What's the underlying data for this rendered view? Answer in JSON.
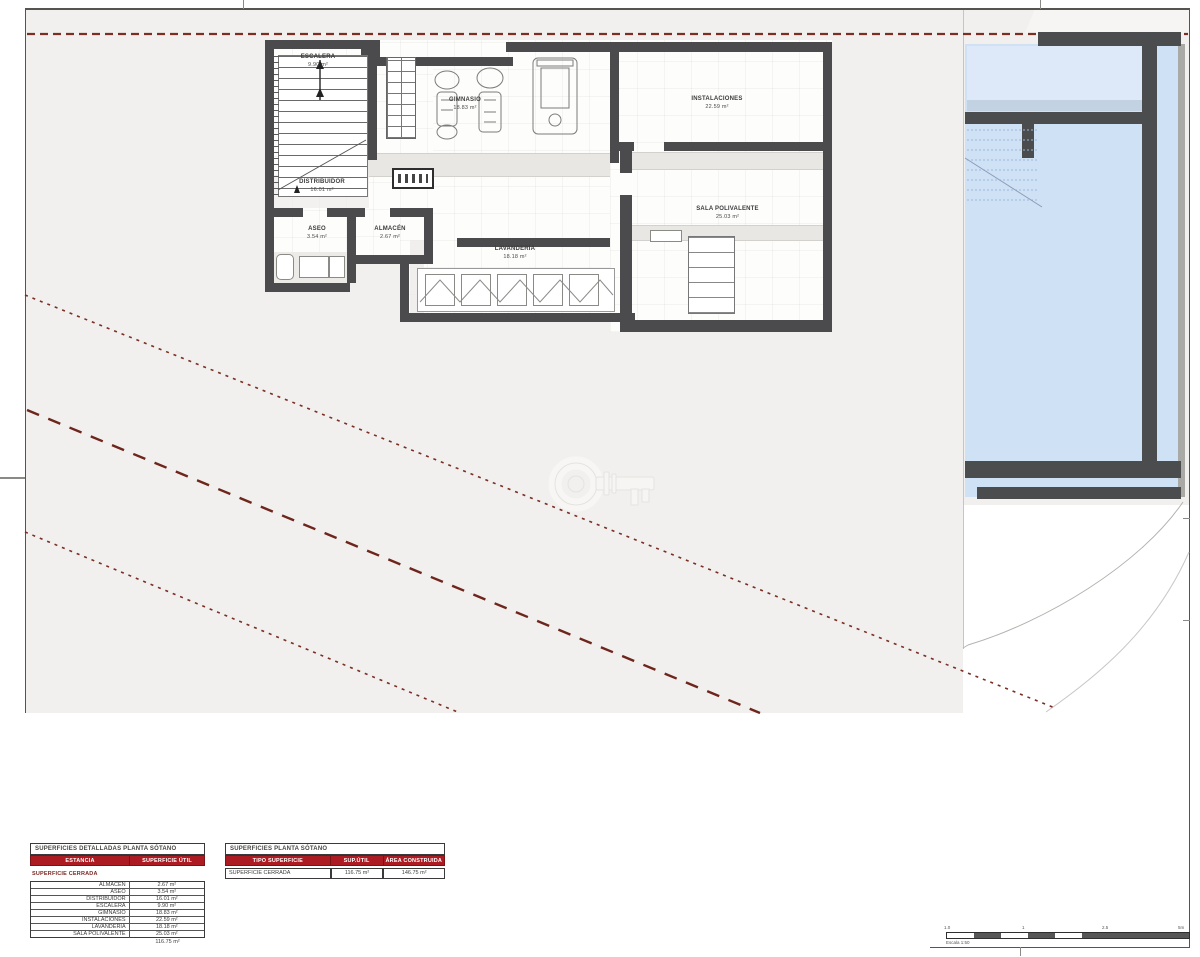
{
  "drawing": {
    "type": "architectural-basement-floor-plan",
    "rooms": [
      {
        "name": "ESCALERA",
        "area": "9.90 m²"
      },
      {
        "name": "GIMNASIO",
        "area": "18.83 m²"
      },
      {
        "name": "INSTALACIONES",
        "area": "22.59 m²"
      },
      {
        "name": "DISTRIBUIDOR",
        "area": "16.01 m²"
      },
      {
        "name": "ASEO",
        "area": "3.54 m²"
      },
      {
        "name": "ALMACÉN",
        "area": "2.67 m²"
      },
      {
        "name": "LAVANDERÍA",
        "area": "18.18 m²"
      },
      {
        "name": "SALA POLIVALENTE",
        "area": "25.03 m²"
      }
    ]
  },
  "tables": {
    "detailed": {
      "title": "SUPERFICIES DETALLADAS PLANTA SÓTANO",
      "headers": [
        "ESTANCIA",
        "SUPERFICIE ÚTIL"
      ],
      "section": "SUPERFICIE CERRADA",
      "rows": [
        {
          "room": "ALMACÉN",
          "value": "2.67 m²"
        },
        {
          "room": "ASEO",
          "value": "3.54 m²"
        },
        {
          "room": "DISTRIBUIDOR",
          "value": "16.01 m²"
        },
        {
          "room": "ESCALERA",
          "value": "9.90 m²"
        },
        {
          "room": "GIMNASIO",
          "value": "18.83 m²"
        },
        {
          "room": "INSTALACIONES",
          "value": "22.59 m²"
        },
        {
          "room": "LAVANDERÍA",
          "value": "18.18 m²"
        },
        {
          "room": "SALA POLIVALENTE",
          "value": "25.03 m²"
        }
      ],
      "total": "116.75 m²"
    },
    "summary": {
      "title": "SUPERFICIES PLANTA SÓTANO",
      "headers": [
        "TIPO SUPERFICIE",
        "SUP.ÚTIL",
        "ÁREA CONSTRUIDA"
      ],
      "row": {
        "tipo": "SUPERFICIE CERRADA",
        "sup_util": "116.75 m²",
        "area_construida": "146.75 m²"
      }
    }
  },
  "scale_bar": {
    "labels": [
      "1.0",
      "1",
      "2.5",
      "5m"
    ],
    "caption": "Escala 1:50"
  },
  "icons": {
    "watermark": "key-icon",
    "level_marker": "level-marker"
  },
  "colors": {
    "sheet_background": "#f1f0ee",
    "wall": "#4b4b4d",
    "pool_water": "#cfe1f4",
    "boundary_dashed_red": "#7b2e24",
    "table_header_red": "#ab1b21"
  }
}
